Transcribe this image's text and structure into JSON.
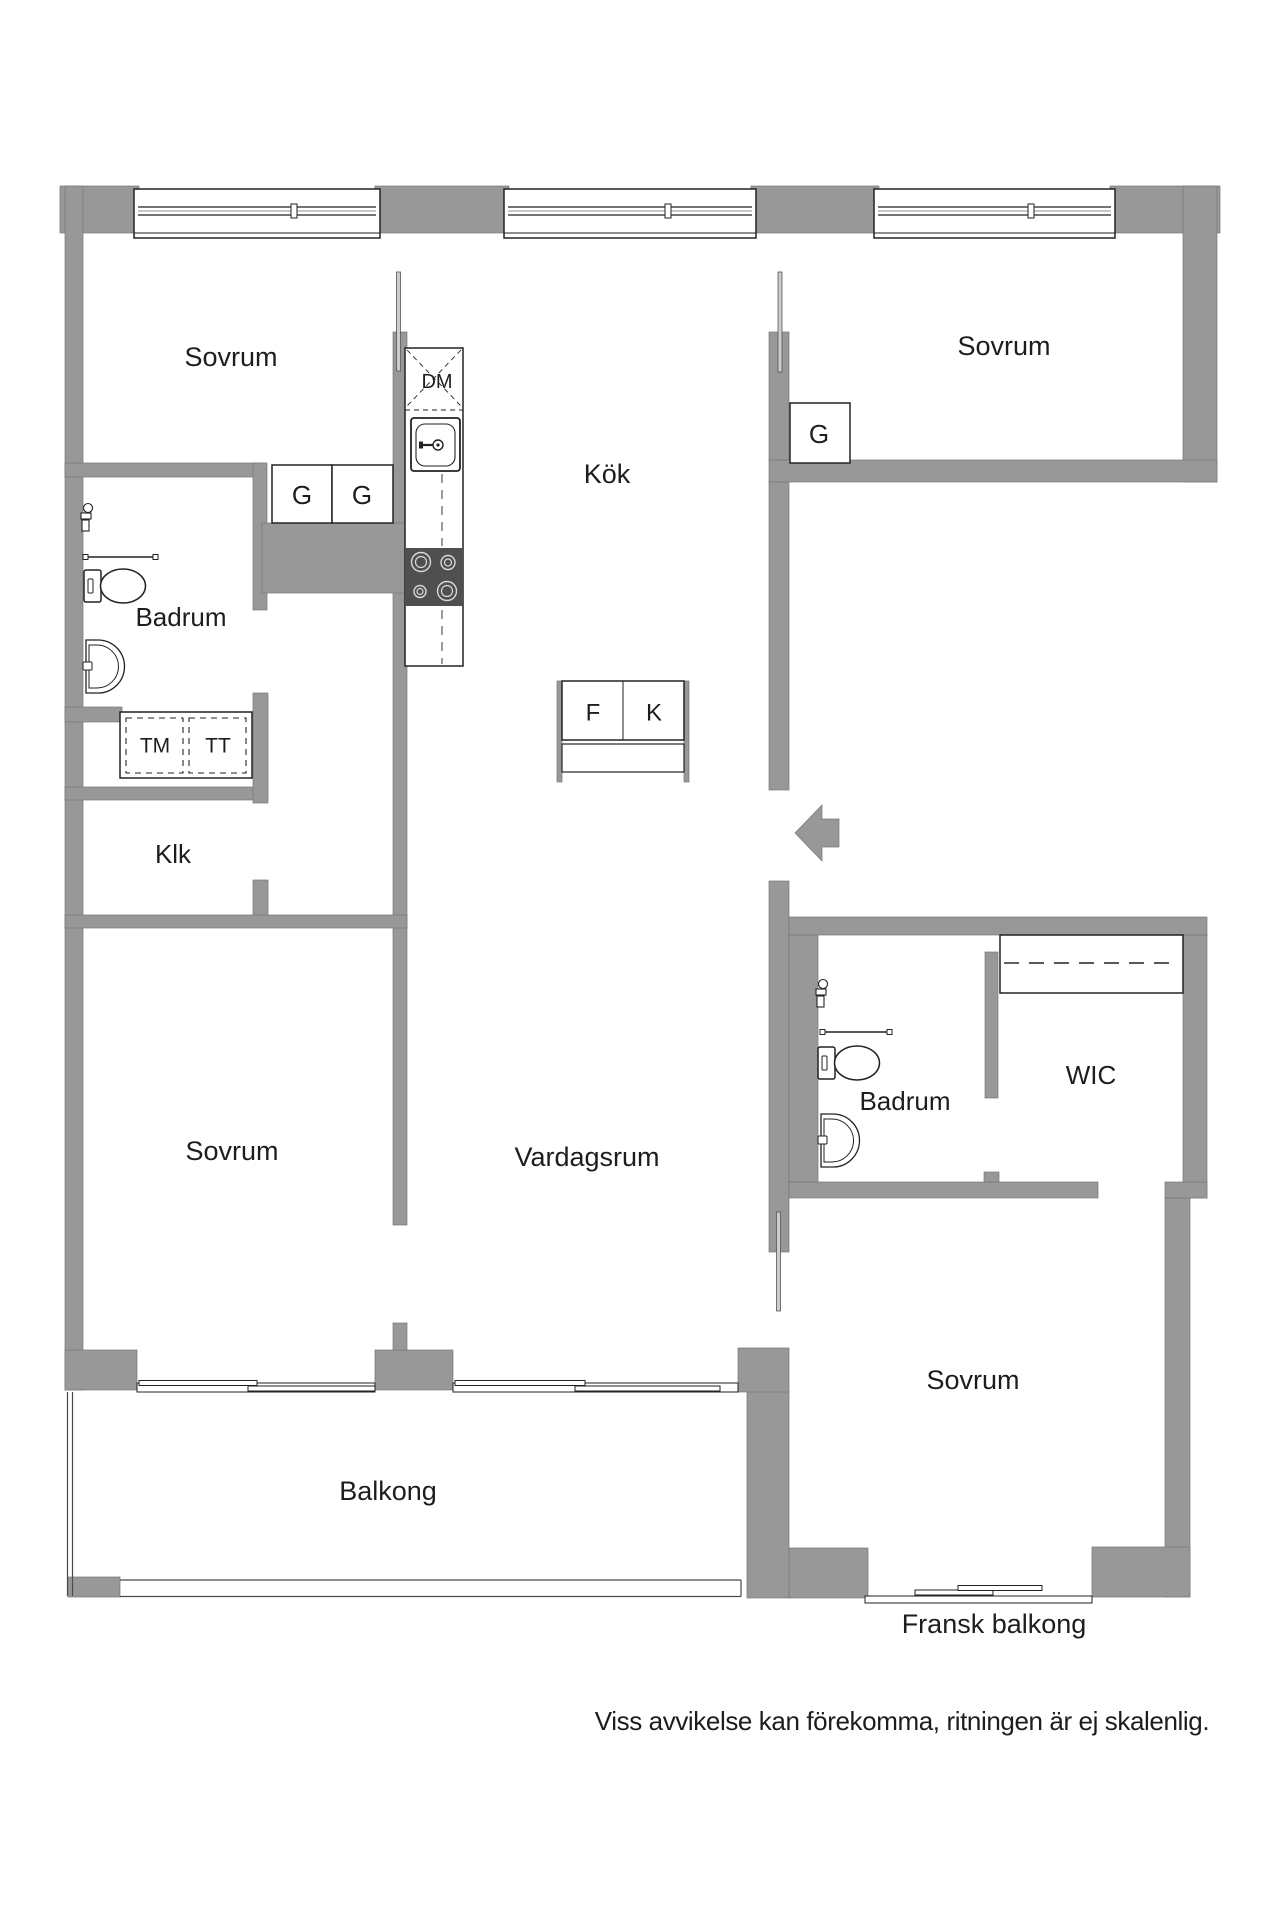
{
  "plan": {
    "rooms": {
      "bedroom_top_left": "Sovrum",
      "bedroom_top_right": "Sovrum",
      "bedroom_bottom_left": "Sovrum",
      "bedroom_bottom_right": "Sovrum",
      "kitchen": "Kök",
      "living_room": "Vardagsrum",
      "bathroom_left": "Badrum",
      "bathroom_right": "Badrum",
      "closet": "Klk",
      "walk_in_closet": "WIC",
      "balcony": "Balkong",
      "french_balcony": "Fransk balkong"
    },
    "fixtures": {
      "dishwasher": "DM",
      "freezer": "F",
      "fridge": "K",
      "washing_machine": "TM",
      "tumble_dryer": "TT",
      "wardrobe_left_1": "G",
      "wardrobe_left_2": "G",
      "wardrobe_bedroom_right": "G"
    },
    "disclaimer": "Viss avvikelse kan förekomma, ritningen är ej skalenlig.",
    "colors": {
      "wall": "#989898",
      "outline": "#222222",
      "stove": "#4f4f4f",
      "background": "#ffffff"
    }
  }
}
